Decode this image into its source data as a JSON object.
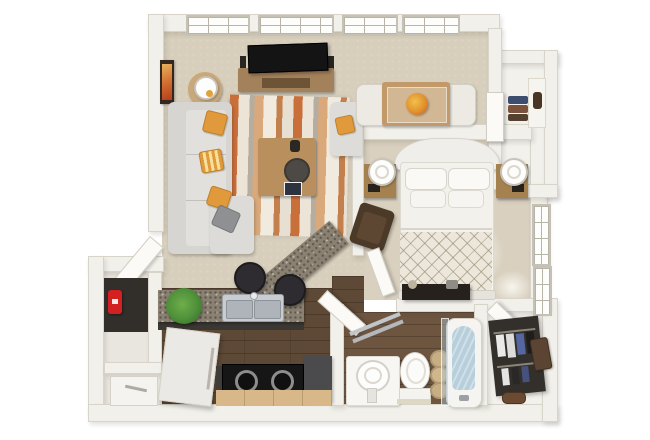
{
  "scene": {
    "title": "3D rendered one-bedroom apartment floor plan, top-down view",
    "style": "photoreal 3D dollhouse floor plan on white background",
    "canvas": {
      "width": 650,
      "height": 440
    },
    "bedrooms_visible": 1,
    "bathrooms_visible": 1
  },
  "colors": {
    "background": "#ffffff",
    "wall": "#f2f0ea",
    "wall_edge": "#d8d3c7",
    "carpet": "#d7cebc",
    "kitchen_wood_floor": "#5e4936",
    "bathroom_wood_floor": "#6e5540",
    "closet_floor": "#f3f1ec",
    "granite_counter": "#8b8173",
    "tan_cabinet": "#d8b788",
    "dark_cabinet": "#403c38",
    "sofa_gray": "#dcdbd7",
    "pillow_orange": "#e09a3c",
    "pillow_gray": "#9b9b99",
    "rug_orange": "#c96f3a",
    "rug_cream": "#ece4d6",
    "rug_tan": "#d9a97c",
    "furniture_wood": "#ab8758",
    "tv_black": "#141414",
    "bed_white": "#f1efe9",
    "duvet_cream": "#ece7da",
    "armchair_brown": "#4c3a29",
    "dresser_dark": "#26211d",
    "stool_dark": "#2e2c30",
    "plant_green": "#4e8f3a",
    "red_appliance": "#d32021",
    "tub_water": "#b7cedb",
    "towel_tan": "#c7ae85",
    "clothes_navy": "#3d4d6e",
    "clothes_brown": "#7b523c"
  },
  "rooms": {
    "living": {
      "label": "Living Room"
    },
    "dining": {
      "label": "Dining Nook"
    },
    "bedroom": {
      "label": "Bedroom"
    },
    "kitchen": {
      "label": "Kitchen"
    },
    "bathroom": {
      "label": "Bathroom"
    },
    "walk_in_closet": {
      "label": "Walk-in Closet"
    },
    "hall_closet": {
      "label": "Hall Closet"
    },
    "entry": {
      "label": "Entry Nook"
    },
    "laundry": {
      "label": "Utility Closet"
    }
  },
  "furniture": {
    "sofa": "Gray sectional sofa with chaise",
    "pillow_orange": "Orange accent pillow",
    "pillow_gray": "Gray accent pillow",
    "tv": "Flat-screen TV",
    "media_console": "Wood media console with speakers",
    "speaker": "Speaker",
    "coffee_table": "Wood coffee table with decor",
    "area_rug": "Striped orange area rug",
    "side_table": "Round side table",
    "table_lamp": "White table lamp",
    "wall_art": "Framed orange wall art",
    "accent_chair": "Gray accent chair",
    "dining_table": "Wood dining table",
    "dining_chair": "Cream upholstered dining chair",
    "centerpiece": "Orange floral centerpiece",
    "bed": "Bed with ornate white headboard and lattice duvet",
    "nightstand": "Wood nightstand",
    "drum_lamp": "White drum lamp",
    "armchair": "Dark brown armchair",
    "dresser": "Dark dresser at foot of bed",
    "counter": "Granite kitchen counter",
    "breakfast_bar": "Angled granite breakfast bar",
    "bar_stool": "Dark round bar stool",
    "kitchen_sink": "Stainless double-basin sink",
    "plant": "Green potted plant",
    "refrigerator": "White refrigerator",
    "cooktop": "Black cooktop with burners",
    "dark_appliance": "Dark gray appliance cabinet",
    "red_appliance": "Red countertop appliance",
    "washer": "White utility appliance",
    "pedestal_sink": "White pedestal sink",
    "toilet": "Toilet",
    "towels": "Rolled tan towels",
    "bathtub": "Bathtub with glass screen and water",
    "towel_ladder": "Chrome towel ladder",
    "wardrobe": "Dark closet organizer with hanging clothes",
    "storage_box": "Brown storage box",
    "shoes": "Shoes",
    "folded_clothes": "Folded clothes stack",
    "garment_bag": "Dark garment bag",
    "window": "White gridded window",
    "door": "White hinged door"
  }
}
